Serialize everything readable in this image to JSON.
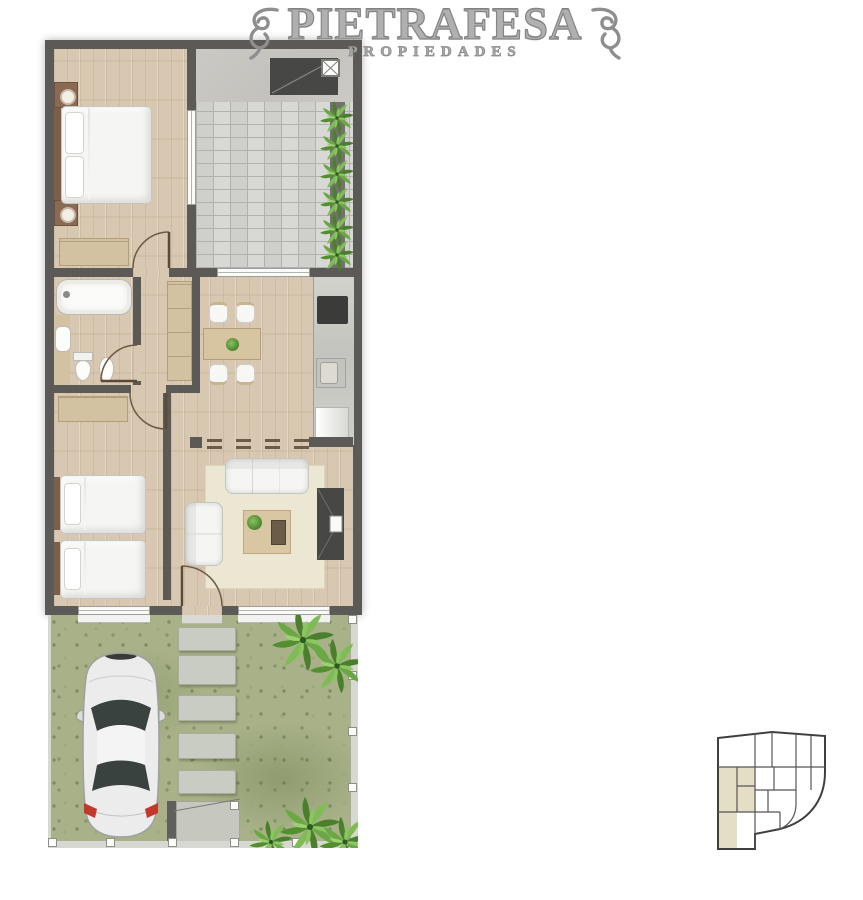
{
  "brand": {
    "name": "PIETRAFESA",
    "tagline": "PROPIEDADES"
  },
  "palette": {
    "wall": "#5c5a56",
    "wood": "#d8c8b1",
    "tile": "#d6d6d3",
    "concrete": "#c8c6c1",
    "grass": "#a8b188",
    "rug": "#ebe7d3",
    "dark_unit": "#474745",
    "closet": "#d2c2a2",
    "fixture_white": "#f5f5f3",
    "unit_highlight": "#e5dec6",
    "logo_gray": "#a3a3a3",
    "stone": "#c9ccc2",
    "plant_green": "#5d9436",
    "car_body": "#ececec",
    "taillight_red": "#c0392b"
  },
  "floor_plan": {
    "rooms": [
      "bedroom-1",
      "terrace-patio",
      "bathroom",
      "hallway",
      "kitchen-dining",
      "bedroom-2",
      "living-room",
      "garden-parking"
    ],
    "furniture": {
      "bedroom_1": [
        "double-bed",
        "nightstand",
        "nightstand",
        "wardrobe"
      ],
      "terrace_patio": [
        "barbecue-grill",
        "chimney",
        "planter-hedge"
      ],
      "bathroom": [
        "bathtub",
        "washbasin",
        "toilet",
        "bidet"
      ],
      "hallway": [
        "closet"
      ],
      "kitchen_dining": [
        "dining-table",
        "four-chairs",
        "countertop",
        "cooktop",
        "sink",
        "refrigerator"
      ],
      "bedroom_2": [
        "single-bed",
        "single-bed",
        "wardrobe"
      ],
      "living_room": [
        "sofa-3-seat",
        "sofa-2-seat",
        "coffee-table",
        "plant",
        "tv-cabinet",
        "area-rug"
      ],
      "garden_parking": [
        "car",
        "stepping-stones",
        "palm-trees",
        "entry-gate",
        "perimeter-fence"
      ]
    }
  },
  "site_key_plan": {
    "highlighted_unit": "left-wing"
  }
}
